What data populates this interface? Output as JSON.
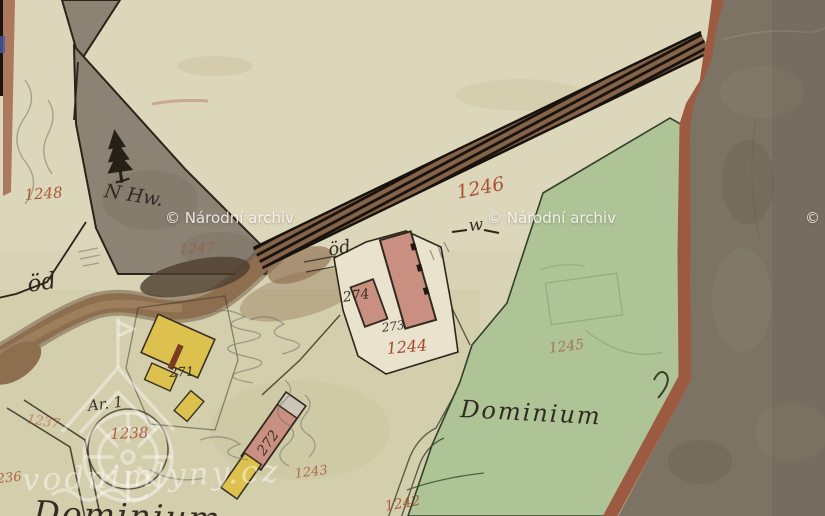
{
  "map": {
    "title": "Historical cadastral map sheet (scan)",
    "source_watermarks": {
      "archive": {
        "text": "© Národní archiv",
        "positions": [
          {
            "x": 165,
            "y": 209
          },
          {
            "x": 487,
            "y": 209
          },
          {
            "x": 805,
            "y": 209
          }
        ]
      },
      "vodnimlyny": {
        "text": "vodnimlyny.cz"
      }
    },
    "labels": [
      {
        "name": "parcel-1248",
        "text": "1248",
        "x": 24,
        "y": 188,
        "size": 15,
        "color": "red",
        "rot": -4,
        "op": 0.9
      },
      {
        "name": "label-n-hw",
        "text": "N Hw.",
        "x": 106,
        "y": 182,
        "size": 19,
        "color": "ink",
        "rot": 9,
        "op": 0.92
      },
      {
        "name": "parcel-1247",
        "text": "1247",
        "x": 179,
        "y": 243,
        "size": 14,
        "color": "red",
        "rot": -3,
        "op": 0.5
      },
      {
        "name": "parcel-1246",
        "text": "1246",
        "x": 455,
        "y": 184,
        "size": 19,
        "color": "red",
        "rot": -11,
        "op": 0.95
      },
      {
        "name": "parcel-1245",
        "text": "1245",
        "x": 548,
        "y": 342,
        "size": 14,
        "color": "red",
        "rot": -7,
        "op": 0.65
      },
      {
        "name": "label-dominium",
        "text": "Dominium",
        "x": 461,
        "y": 397,
        "size": 24,
        "color": "ink",
        "rot": 3,
        "op": 0.95,
        "cls": "lbl-dominium"
      },
      {
        "name": "parcel-1244",
        "text": "1244",
        "x": 386,
        "y": 341,
        "size": 16,
        "color": "red",
        "rot": -5,
        "op": 1
      },
      {
        "name": "parcel-1243",
        "text": "1243",
        "x": 294,
        "y": 468,
        "size": 13,
        "color": "red",
        "rot": -7,
        "op": 0.75
      },
      {
        "name": "parcel-1242",
        "text": "1242",
        "x": 384,
        "y": 500,
        "size": 14,
        "color": "red",
        "rot": -10,
        "op": 0.85
      },
      {
        "name": "parcel-1238",
        "text": "1238",
        "x": 110,
        "y": 427,
        "size": 15,
        "color": "red",
        "rot": -2,
        "op": 0.85
      },
      {
        "name": "parcel-1237",
        "text": "1237",
        "x": 28,
        "y": 413,
        "size": 13,
        "color": "red",
        "rot": 9,
        "op": 0.5
      },
      {
        "name": "parcel-1236",
        "text": "1236",
        "x": -12,
        "y": 474,
        "size": 13,
        "color": "red",
        "rot": -6,
        "op": 0.8
      },
      {
        "name": "house-274",
        "text": "274",
        "x": 342,
        "y": 291,
        "size": 14,
        "color": "ink",
        "rot": -8,
        "op": 0.9
      },
      {
        "name": "house-273",
        "text": "273",
        "x": 381,
        "y": 322,
        "size": 12,
        "color": "ink",
        "rot": -8,
        "op": 0.9
      },
      {
        "name": "house-272",
        "text": "272",
        "x": 255,
        "y": 450,
        "size": 14,
        "color": "ink",
        "rot": -55,
        "op": 0.9
      },
      {
        "name": "house-271",
        "text": "271",
        "x": 169,
        "y": 367,
        "size": 13,
        "color": "ink",
        "rot": -3,
        "op": 0.9
      },
      {
        "name": "label-od-west",
        "text": "öd",
        "x": 26,
        "y": 274,
        "size": 23,
        "color": "ink",
        "rot": -8,
        "op": 0.95
      },
      {
        "name": "label-od-center",
        "text": "öd",
        "x": 327,
        "y": 242,
        "size": 18,
        "color": "ink",
        "rot": -10,
        "op": 0.95
      },
      {
        "name": "label-ar-1",
        "text": "Ar. 1",
        "x": 87,
        "y": 399,
        "size": 15,
        "color": "ink",
        "rot": -7,
        "op": 0.9
      },
      {
        "name": "symbol-meadow-w",
        "text": "w",
        "x": 468,
        "y": 218,
        "size": 17,
        "color": "ink",
        "rot": -5,
        "op": 0.95
      },
      {
        "name": "label-dominium-bottom",
        "text": "Dominium",
        "x": 34,
        "y": 496,
        "size": 33,
        "color": "ink",
        "rot": 2,
        "op": 0.95,
        "cls": "lbl-dominium"
      }
    ],
    "symbols": [
      "conifer-tree-icon",
      "meadow-w-icon",
      "water-mill-watermark-icon"
    ],
    "colors": {
      "paper": "#d8d3b5",
      "paper_light": "#e0dcc2",
      "paper_olive": "#cfcba4",
      "forest_gray": "#8c8375",
      "meadow_green": "#aec496",
      "road_brown": "#8a6848",
      "stream_brown": "#8d6f50",
      "building_pink": "#c98f80",
      "building_yellow": "#ddc14e",
      "ink": "#2b241c",
      "red_number": "#a8492e",
      "border_red": "#9c5a40",
      "scan_background": "#7c7365"
    }
  }
}
